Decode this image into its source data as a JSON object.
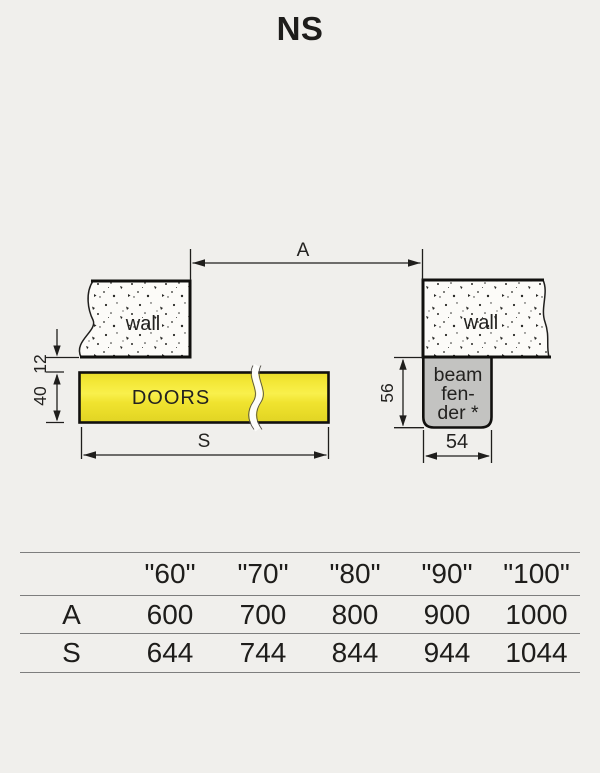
{
  "title": "NS",
  "diagram": {
    "labels": {
      "dim_a": "A",
      "dim_s": "S",
      "dim_12": "12",
      "dim_40": "40",
      "dim_56": "56",
      "dim_54": "54",
      "wall_left": "wall",
      "wall_right": "wall",
      "doors": "DOORS",
      "beam_fender_line1": "beam",
      "beam_fender_line2": "fen-",
      "beam_fender_line3": "der *"
    },
    "colors": {
      "doors_yellow": "#f0e32e",
      "beam_fender_gray": "#c3c3c1",
      "wall_fill": "#fcfbf8",
      "background": "#f0efec",
      "line": "#1f1e1c"
    }
  },
  "table": {
    "headers": [
      "\"60\"",
      "\"70\"",
      "\"80\"",
      "\"90\"",
      "\"100\""
    ],
    "rows": [
      {
        "label": "A",
        "values": [
          "600",
          "700",
          "800",
          "900",
          "1000"
        ]
      },
      {
        "label": "S",
        "values": [
          "644",
          "744",
          "844",
          "944",
          "1044"
        ]
      }
    ]
  }
}
